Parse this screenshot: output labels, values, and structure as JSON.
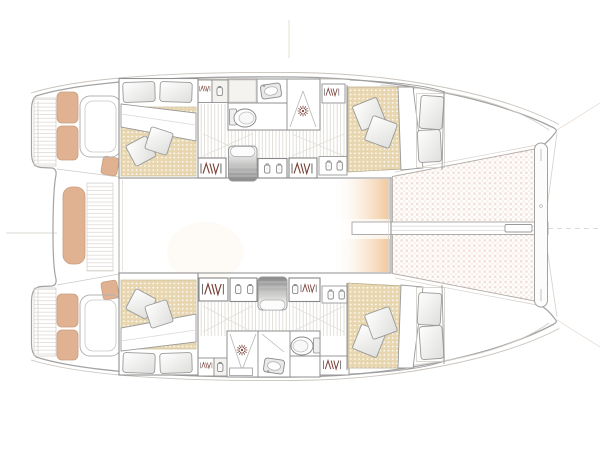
{
  "labels": {
    "plan": "Catamaran deck and accommodation floor plan, bow to the right",
    "cockpit": "Aft cockpit",
    "bench": "Cockpit bench seat",
    "transom_steps": "Transom swim steps",
    "helm_seat": "Cockpit seat coaming",
    "saloon": "Saloon bridge deck",
    "trampoline": "Bow trampoline net",
    "beam": "Longitudinal bow beam",
    "crossbeam": "Forward crossbeam",
    "bowsprit": "Bowsprit fitting",
    "port_hull": "Port hull (top)",
    "starboard_hull": "Starboard hull (bottom)",
    "aft_cabin": "Aft double cabin",
    "fwd_cabin": "Forward double cabin",
    "head": "Head compartment",
    "shower": "Shower with drain",
    "toilet": "Toilet",
    "sink": "Washbasin",
    "steps": "Companionway steps",
    "locker": "Hanging locker",
    "cabinet": "Storage cabinet",
    "bed": "Double berth mattress",
    "pillow": "Pillow",
    "duvet": "Folded duvet",
    "berth_cushion": "Forepeak berth cushion",
    "rigging": "Rigging reference lines"
  },
  "colors": {
    "hull_outline": "#a3a3a3",
    "rub_rail": "#c9c3bd",
    "wall": "#8f8f8f",
    "cushion": "#e1b292",
    "cushion_border": "#c79e7e",
    "mattress": "#e8d7b0",
    "mattress_dot": "#ffffff",
    "trampoline_net": "#f1dfd7",
    "locker_glyph": "#7b4238",
    "icon_gray": "#8a8a8a",
    "floor_line": "#d7d2ca",
    "plank_line": "#d9d5cf",
    "steps_dark": "#888888",
    "steps_light": "#f7f7f6",
    "glow": "#f0c493",
    "faint_line": "#e2d8d0"
  },
  "diagram": {
    "type": "catamaran-deck-plan",
    "orientation": {
      "bow": "right",
      "stern": "left"
    },
    "hulls": [
      "port (top)",
      "starboard (bottom)"
    ],
    "per_hull_features": [
      "aft double cabin with mattress, duvet and pillows",
      "hanging lockers and storage cabinets",
      "companionway steps",
      "head with washbasin, toilet and shower",
      "forward double cabin with forepeak berth cushions"
    ],
    "shared_features": [
      "aft cockpit with bench and cushioned seats",
      "open saloon bridge deck",
      "bow trampoline with longitudinal beam, forward crossbeam and bowsprit fitting"
    ]
  }
}
